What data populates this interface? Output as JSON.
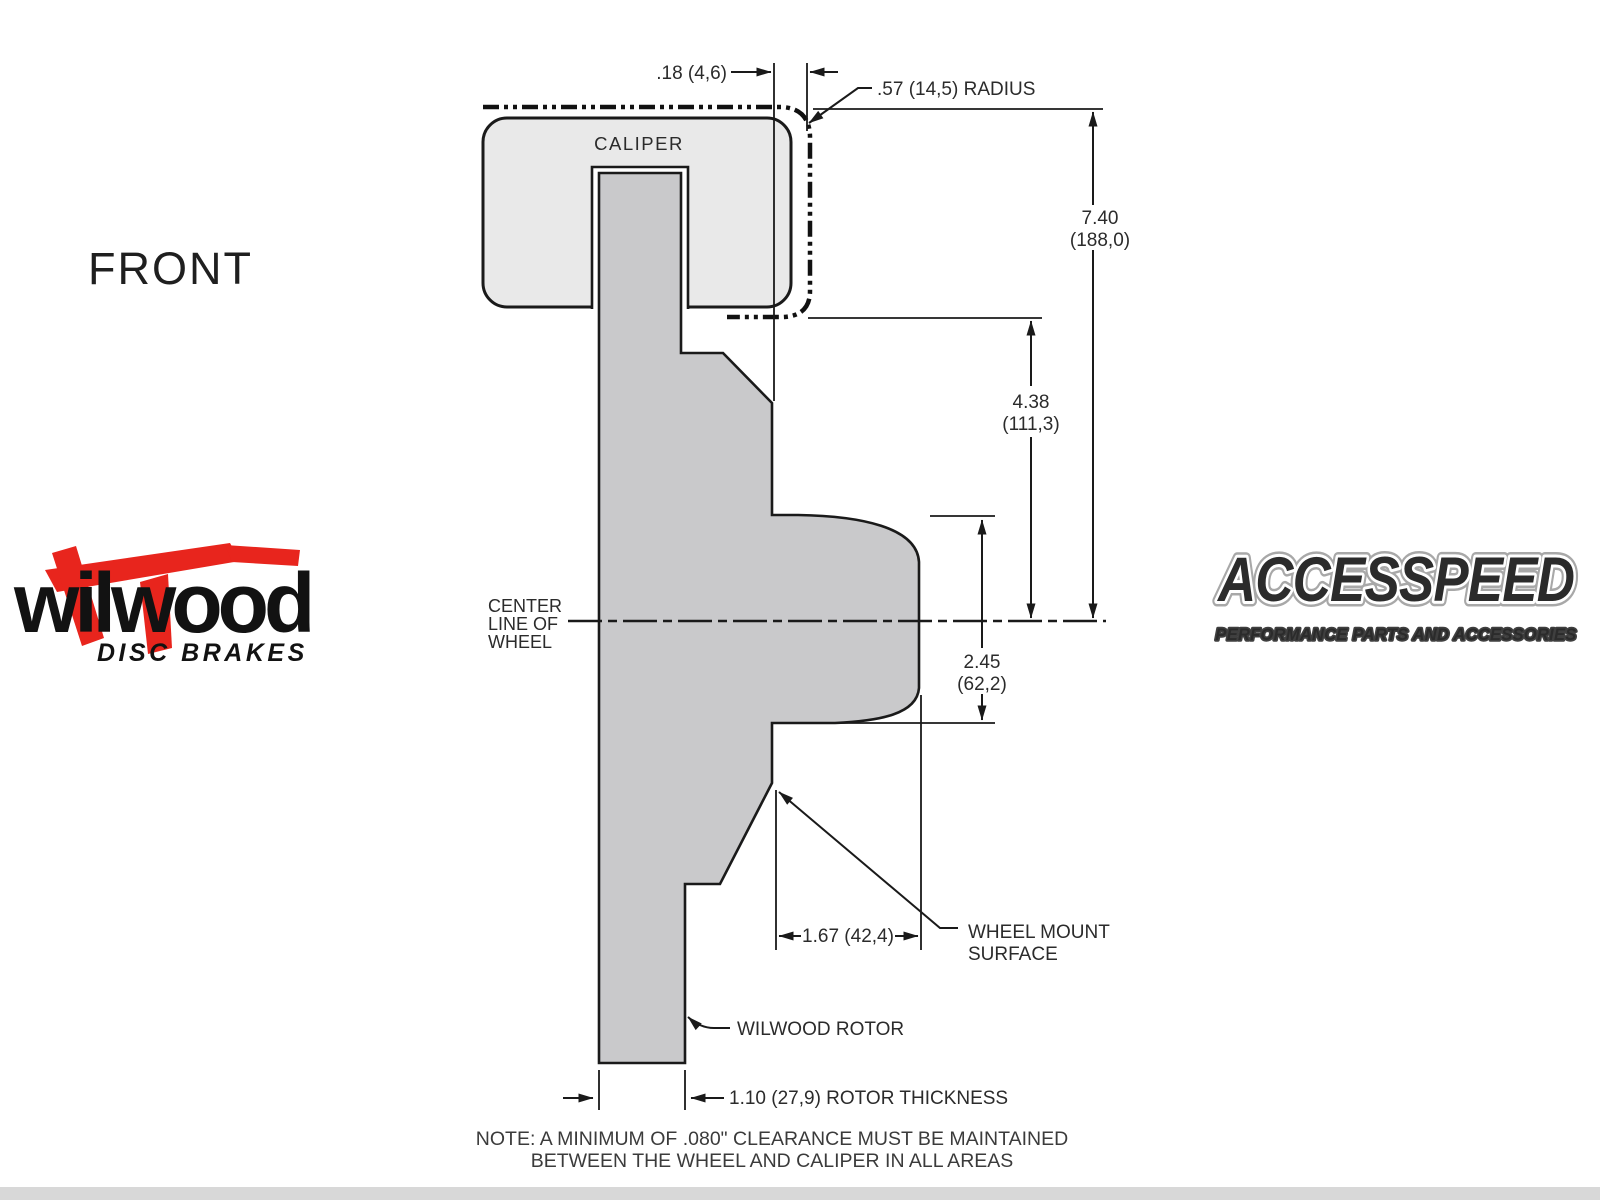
{
  "drawing": {
    "view_label": "FRONT",
    "caliper_label": "CALIPER",
    "center_line_label": [
      "CENTER",
      "LINE OF",
      "WHEEL"
    ],
    "dimensions": {
      "caliper_clearance": ".18 (4,6)",
      "corner_radius": ".57 (14,5) RADIUS",
      "overall_height": [
        "7.40",
        "(188,0)"
      ],
      "caliper_to_center": [
        "4.38",
        "(111,3)"
      ],
      "hub_height": [
        "2.45",
        "(62,2)"
      ],
      "mount_offset": "1.67 (42,4)",
      "rotor_thickness": "1.10 (27,9) ROTOR THICKNESS"
    },
    "labels": {
      "wheel_mount_surface": [
        "WHEEL MOUNT",
        "SURFACE"
      ],
      "rotor": "WILWOOD ROTOR"
    },
    "note": [
      "NOTE: A MINIMUM OF .080\" CLEARANCE MUST BE MAINTAINED",
      "BETWEEN THE WHEEL AND CALIPER IN ALL AREAS"
    ]
  },
  "logos": {
    "wilwood": {
      "name": "wilwood",
      "tagline": "DISC BRAKES"
    },
    "accesspeed": {
      "name": "ACCESSPEED",
      "tagline": "PERFORMANCE PARTS AND ACCESSORIES"
    }
  },
  "colors": {
    "line": "#1a1a1a",
    "caliper_fill": "#e9e9e9",
    "rotor_fill": "#c9c9cb",
    "wilwood_red": "#e8251d",
    "footer_strip": "#d8d8d8"
  }
}
